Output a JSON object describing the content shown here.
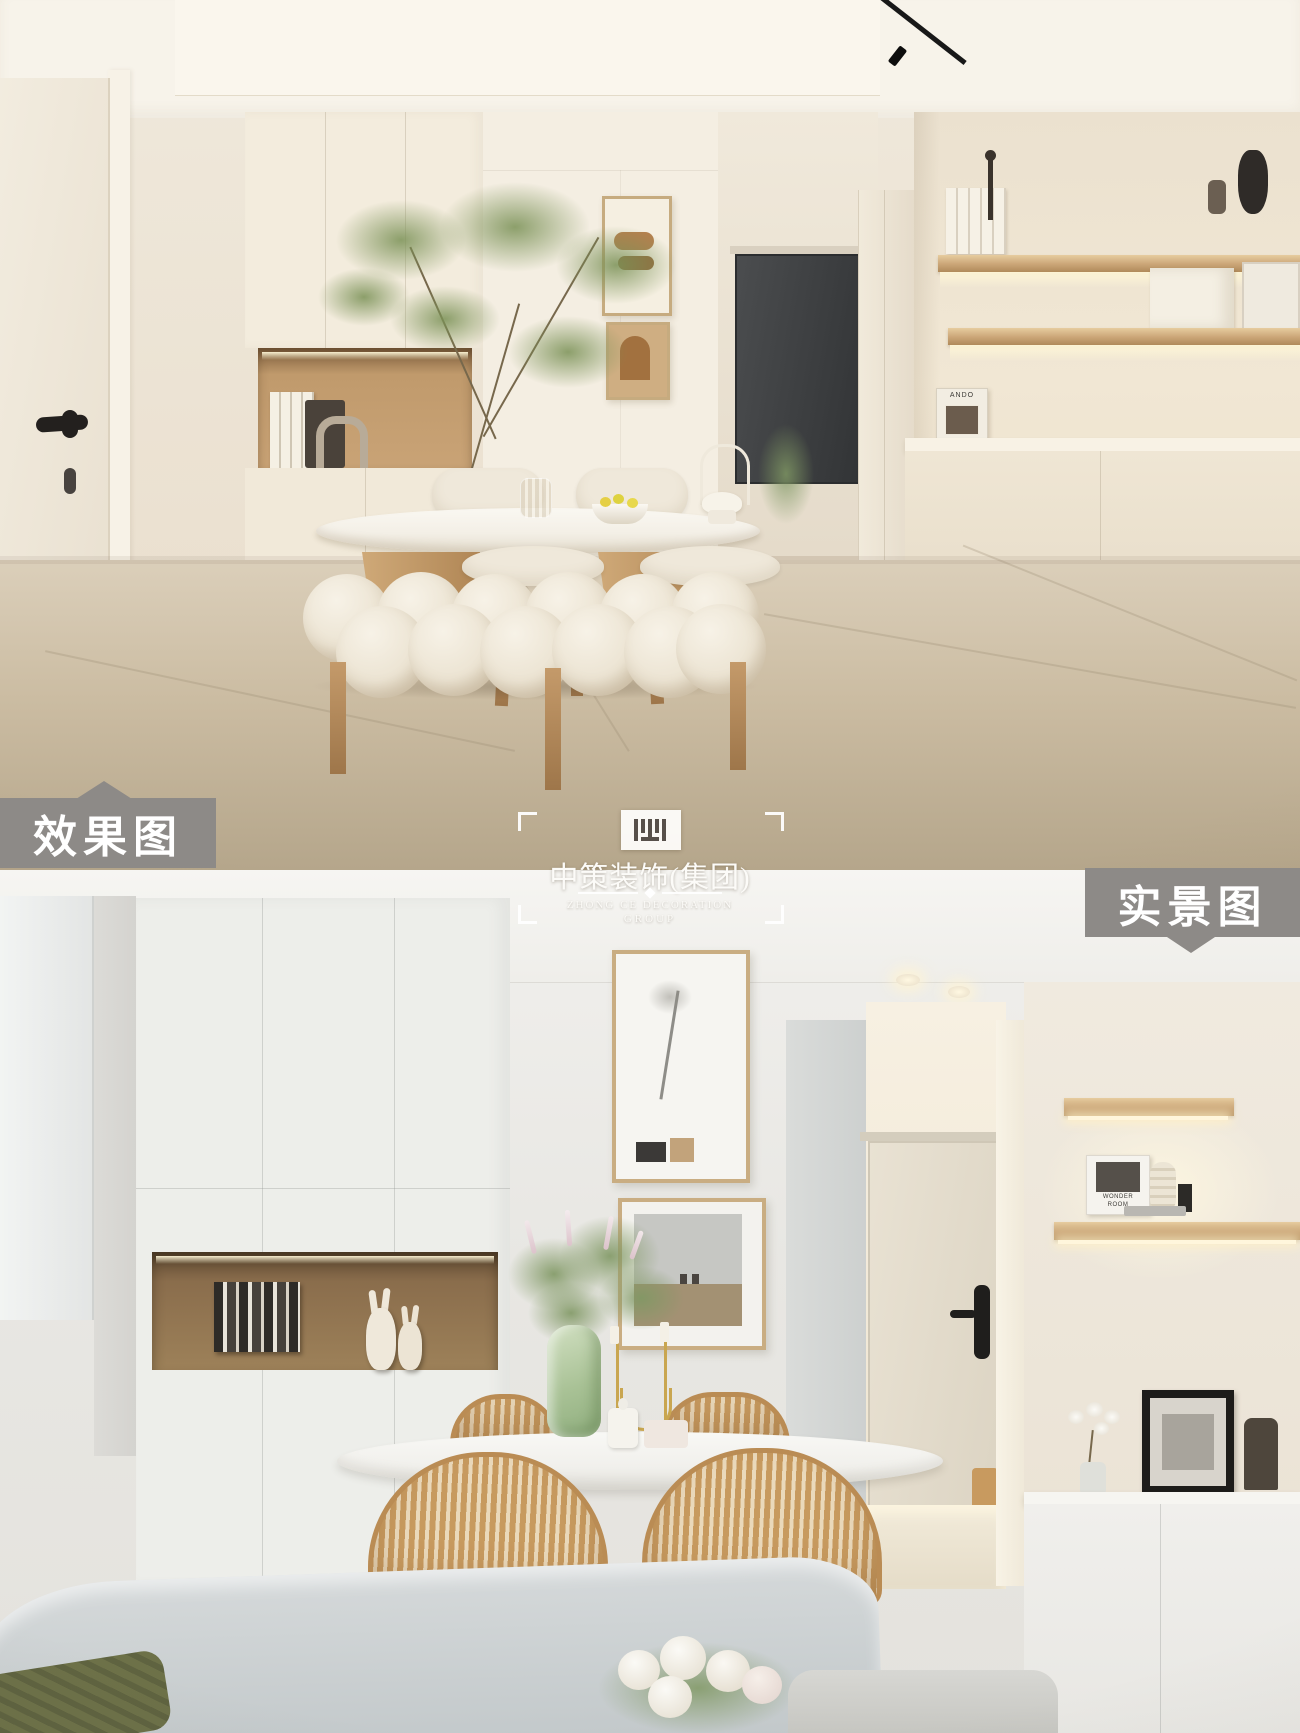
{
  "image": {
    "width": 1300,
    "height": 1733,
    "kind": "interior design rendering vs real photo comparison"
  },
  "labels": {
    "render": "效果图",
    "real": "实景图"
  },
  "watermark": {
    "company_cn": "中策装饰(集团)",
    "company_en_line1": "ZHONG CE DECORATION",
    "company_en_line2": "GROUP"
  },
  "decor": {
    "render_book": "ANDO",
    "real_book_line1": "WONDER",
    "real_book_line2": "ROOM"
  },
  "colors": {
    "label_bg": "#8d8a87",
    "label_text": "#ffffff",
    "render_wall": "#ece3d4",
    "render_floor": "#c9bca6",
    "render_wood": "#c9a275",
    "real_wall": "#e9e8e4",
    "real_niche_wood": "#8a6d4c",
    "rattan": "#c79a5f",
    "vase_green": "#a8c295",
    "watermark_text": "#fcfbf8"
  }
}
